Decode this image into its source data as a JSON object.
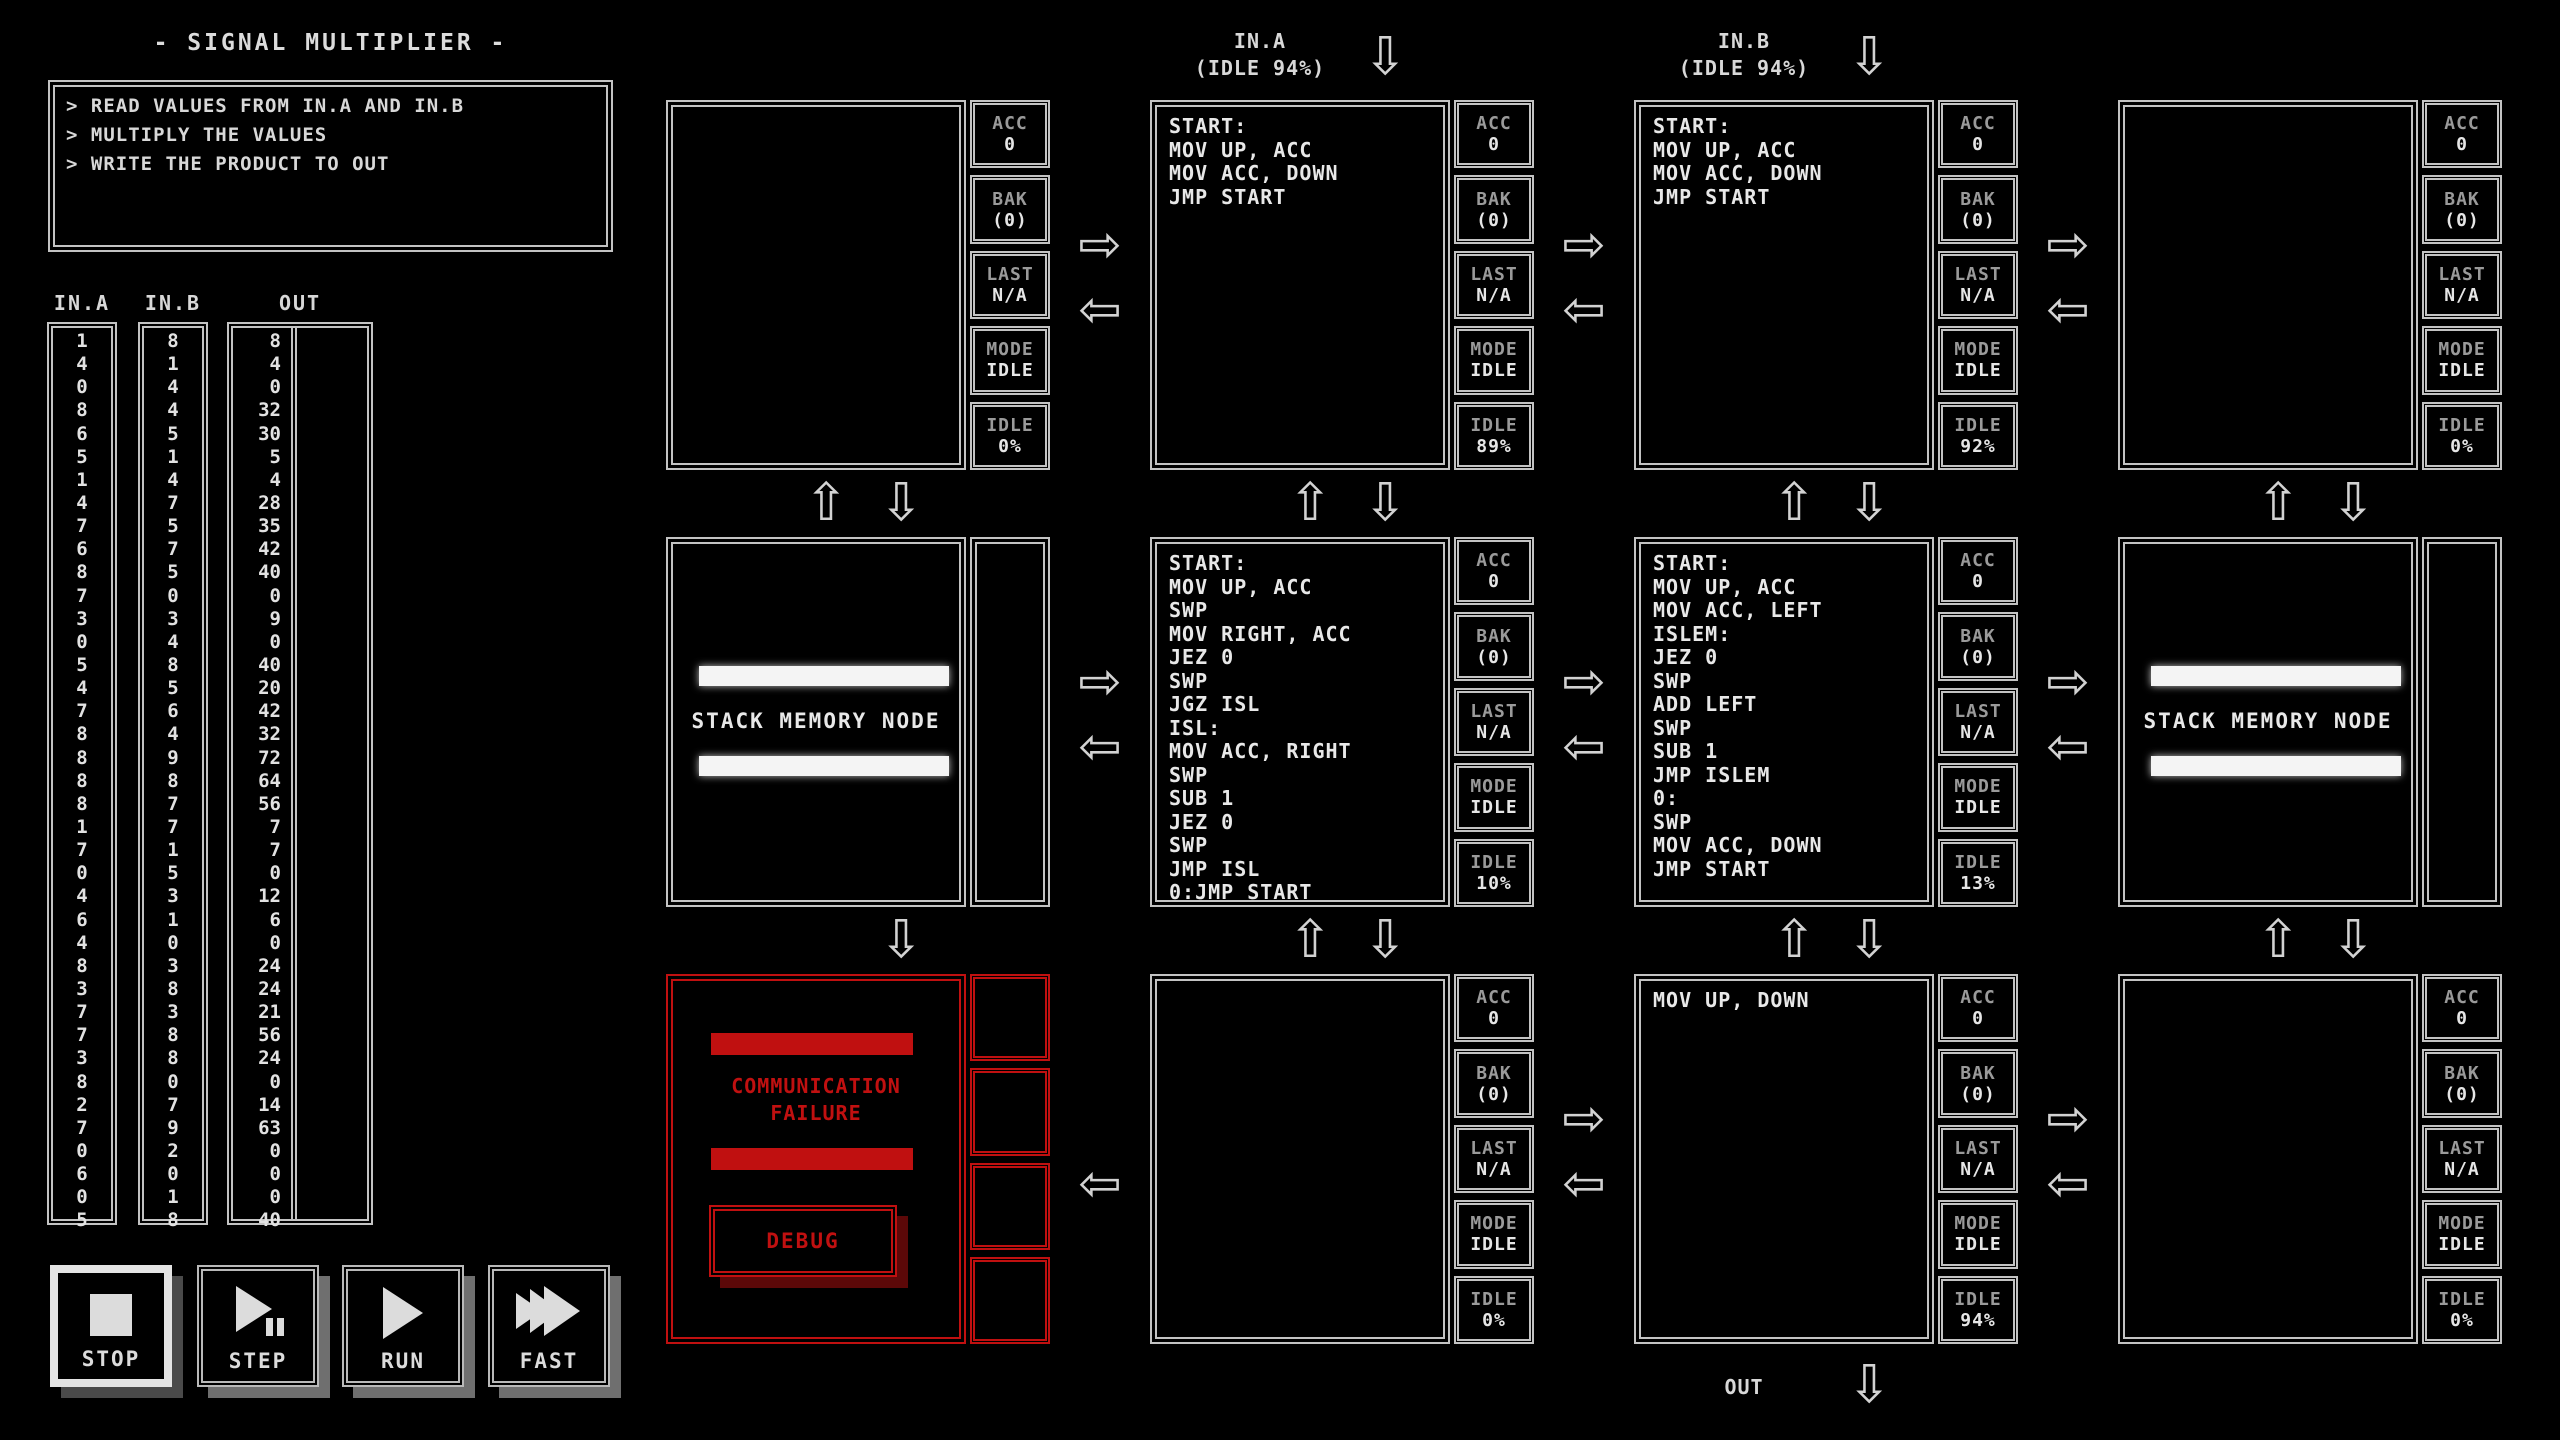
{
  "title": "- SIGNAL MULTIPLIER -",
  "description": [
    "> READ VALUES FROM IN.A AND IN.B",
    "> MULTIPLY THE VALUES",
    "> WRITE THE PRODUCT TO OUT"
  ],
  "io": {
    "in_a": {
      "header": "IN.A",
      "values": [
        1,
        4,
        0,
        8,
        6,
        5,
        1,
        4,
        7,
        6,
        8,
        7,
        3,
        0,
        5,
        4,
        7,
        8,
        8,
        8,
        8,
        1,
        7,
        0,
        4,
        6,
        4,
        8,
        3,
        7,
        7,
        3,
        8,
        2,
        7,
        0,
        6,
        0,
        5
      ]
    },
    "in_b": {
      "header": "IN.B",
      "values": [
        8,
        1,
        4,
        4,
        5,
        1,
        4,
        7,
        5,
        7,
        5,
        0,
        3,
        4,
        8,
        5,
        6,
        4,
        9,
        8,
        7,
        7,
        1,
        5,
        3,
        1,
        0,
        3,
        8,
        3,
        8,
        8,
        0,
        7,
        9,
        2,
        0,
        1,
        8
      ]
    },
    "out": {
      "header": "OUT",
      "expected": [
        8,
        4,
        0,
        32,
        30,
        5,
        4,
        28,
        35,
        42,
        40,
        0,
        9,
        0,
        40,
        20,
        42,
        32,
        72,
        64,
        56,
        7,
        7,
        0,
        12,
        6,
        0,
        24,
        24,
        21,
        56,
        24,
        0,
        14,
        63,
        0,
        0,
        0,
        40
      ],
      "actual": []
    }
  },
  "ports": {
    "in_a": {
      "name": "IN.A",
      "idle": "(IDLE 94%)"
    },
    "in_b": {
      "name": "IN.B",
      "idle": "(IDLE 94%)"
    },
    "out": {
      "name": "OUT"
    }
  },
  "status_labels": {
    "acc": "ACC",
    "bak": "BAK",
    "last": "LAST",
    "mode": "MODE",
    "idle": "IDLE"
  },
  "nodes": {
    "r1c1": {
      "type": "compute",
      "code": [],
      "acc": "0",
      "bak": "(0)",
      "last": "N/A",
      "mode": "IDLE",
      "idle": "0%"
    },
    "r1c2": {
      "type": "compute",
      "code": [
        "START:",
        "MOV UP, ACC",
        "MOV ACC, DOWN",
        "JMP START"
      ],
      "acc": "0",
      "bak": "(0)",
      "last": "N/A",
      "mode": "IDLE",
      "idle": "89%"
    },
    "r1c3": {
      "type": "compute",
      "code": [
        "START:",
        "MOV UP, ACC",
        "MOV ACC, DOWN",
        "JMP START"
      ],
      "acc": "0",
      "bak": "(0)",
      "last": "N/A",
      "mode": "IDLE",
      "idle": "92%"
    },
    "r1c4": {
      "type": "compute",
      "code": [],
      "acc": "0",
      "bak": "(0)",
      "last": "N/A",
      "mode": "IDLE",
      "idle": "0%"
    },
    "r2c1": {
      "type": "stack",
      "label": "STACK MEMORY NODE"
    },
    "r2c2": {
      "type": "compute",
      "code": [
        "START:",
        "MOV UP, ACC",
        "SWP",
        "MOV RIGHT, ACC",
        "JEZ 0",
        "SWP",
        "JGZ ISL",
        "ISL:",
        "MOV ACC, RIGHT",
        "SWP",
        "SUB 1",
        "JEZ 0",
        "SWP",
        "JMP ISL",
        "0:JMP START"
      ],
      "acc": "0",
      "bak": "(0)",
      "last": "N/A",
      "mode": "IDLE",
      "idle": "10%"
    },
    "r2c3": {
      "type": "compute",
      "code": [
        "START:",
        "MOV UP, ACC",
        "MOV ACC, LEFT",
        "ISLEM:",
        "JEZ 0",
        "SWP",
        "ADD LEFT",
        "SWP",
        "SUB 1",
        "JMP ISLEM",
        "0:",
        "SWP",
        "MOV ACC, DOWN",
        "JMP START"
      ],
      "acc": "0",
      "bak": "(0)",
      "last": "N/A",
      "mode": "IDLE",
      "idle": "13%"
    },
    "r2c4": {
      "type": "stack",
      "label": "STACK MEMORY NODE"
    },
    "r3c1": {
      "type": "failure",
      "message": [
        "COMMUNICATION",
        "FAILURE"
      ],
      "debug_label": "DEBUG"
    },
    "r3c2": {
      "type": "compute",
      "code": [],
      "acc": "0",
      "bak": "(0)",
      "last": "N/A",
      "mode": "IDLE",
      "idle": "0%"
    },
    "r3c3": {
      "type": "compute",
      "code": [
        "MOV UP, DOWN"
      ],
      "acc": "0",
      "bak": "(0)",
      "last": "N/A",
      "mode": "IDLE",
      "idle": "94%"
    },
    "r3c4": {
      "type": "compute",
      "code": [],
      "acc": "0",
      "bak": "(0)",
      "last": "N/A",
      "mode": "IDLE",
      "idle": "0%"
    }
  },
  "controls": {
    "stop": "STOP",
    "step": "STEP",
    "run": "RUN",
    "fast": "FAST"
  },
  "icons": {
    "arrow_up": "⇧",
    "arrow_down": "⇩",
    "arrow_left": "⇦",
    "arrow_right": "⇨"
  },
  "colors": {
    "foreground": "#e4e4e4",
    "dim_label": "#9a9a9a",
    "border": "#c3c3c3",
    "failure_red": "#c01010",
    "background": "#000000"
  }
}
